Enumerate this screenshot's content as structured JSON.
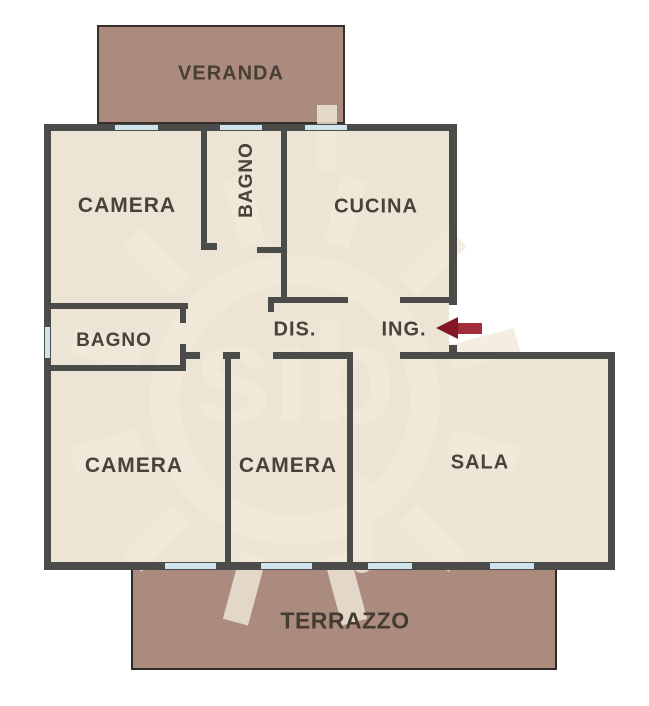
{
  "rooms": {
    "veranda": {
      "label": "VERANDA"
    },
    "camera_nw": {
      "label": "CAMERA"
    },
    "bagno_top": {
      "label": "BAGNO"
    },
    "cucina": {
      "label": "CUCINA"
    },
    "bagno_left": {
      "label": "BAGNO"
    },
    "dis": {
      "label": "DIS."
    },
    "ing": {
      "label": "ING."
    },
    "camera_sw": {
      "label": "CAMERA"
    },
    "camera_s": {
      "label": "CAMERA"
    },
    "sala": {
      "label": "SALA"
    },
    "terrazzo": {
      "label": "TERRAZZO"
    }
  },
  "entrance": {
    "room": "ING.",
    "arrow_points": "left"
  },
  "colors": {
    "background": "#ffffff",
    "room": "#ece4d4",
    "outdoor": "#ab8b7e",
    "wall": "#4b4b49",
    "window": "#cfe4ed",
    "label": "#4a4138",
    "arrow": "#a32c3c",
    "arrowhead": "#841726",
    "watermark": "#f2ebdc"
  }
}
